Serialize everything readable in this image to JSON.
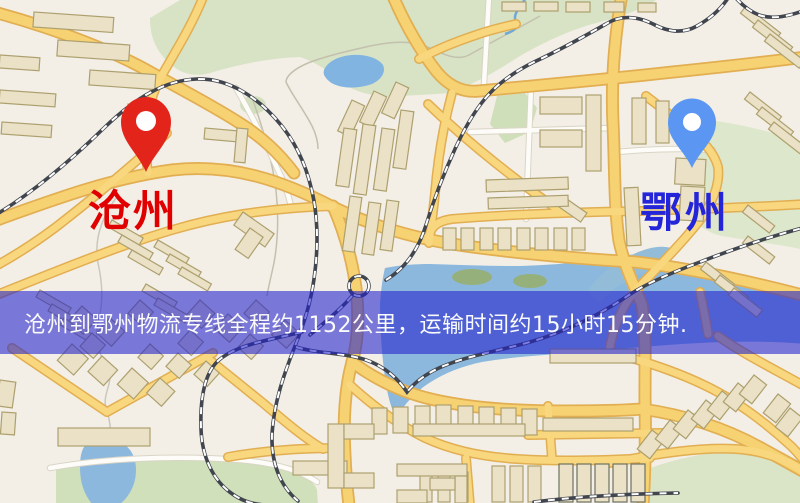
{
  "canvas": {
    "width": 800,
    "height": 503
  },
  "markers": {
    "origin": {
      "name": "沧州",
      "pin_color": "#e3241b",
      "pin_stroke": "#b51408",
      "label_color": "#e10000"
    },
    "destination": {
      "name": "鄂州",
      "pin_color": "#5b97f2",
      "pin_stroke": "#3f7de0",
      "label_color": "#2424d8"
    }
  },
  "banner": {
    "text": "沧州到鄂州物流专线全程约1152公里，运输时间约15小时15分钟.",
    "background": "rgba(32,32,205,0.58)",
    "text_color": "#fafafa",
    "route": {
      "origin": "沧州",
      "destination": "鄂州",
      "service": "物流专线",
      "distance": "约1152公里",
      "duration": "约15小时15分钟"
    }
  },
  "map_palette": {
    "background": "#f3efe6",
    "road_fill": "#f6d272",
    "road_casing": "#e2ae52",
    "minor_road": "#fdfcf8",
    "water": "#8db8dd",
    "green": "#d7e3c4",
    "building": "#eae1c6",
    "railway": "#41454e"
  }
}
